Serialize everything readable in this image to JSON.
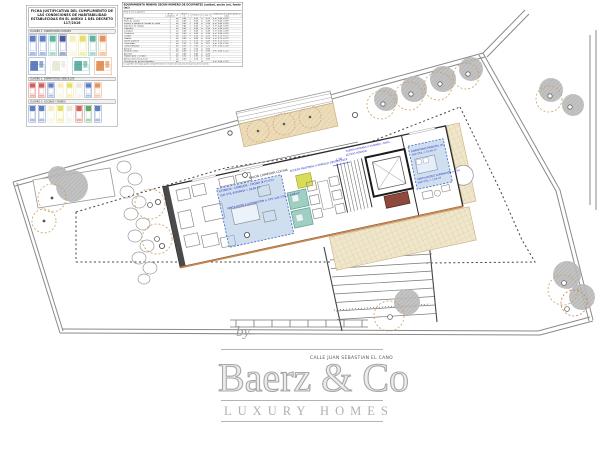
{
  "panel": {
    "title": "FICHA JUSTIFICATIVA DEL CUMPLIMIENTO DE LAS CONDICIONES DE HABITABILIDAD ESTABLECIDAS EN EL ANEXO 1 DEL DECRETO 117/2016",
    "rows": [
      {
        "bar": "CUADRO 1. DORMITORIOS DOBLES",
        "type": "tall",
        "items": [
          "blue",
          "blue",
          "teal",
          "navy",
          "paleYellow",
          "yellow",
          "teal",
          "orange"
        ]
      },
      {
        "bar": "",
        "type": "rooms",
        "items": [
          "blue",
          "pale",
          "teal",
          "orange"
        ]
      },
      {
        "bar": "CUADRO 2. DORMITORIOS SENCILLOS",
        "type": "mid",
        "items": [
          "red",
          "red",
          "blue",
          "paleYellow",
          "yellow",
          "pale",
          "blue",
          "orange"
        ]
      },
      {
        "bar": "CUADRO 3. COCINAS Y BAÑOS",
        "type": "mid2",
        "items": [
          "blue",
          "blue",
          "paleYellow",
          "yellow",
          "pale",
          "red",
          "green",
          "blue"
        ]
      }
    ]
  },
  "table": {
    "title": "EQUIPAMIENTO MÍNIMO SEGÚN NÚMERO DE OCUPANTES (unidad, ancho (m), fondo (m))",
    "subtitle": "Para 5 ó 6 ocupantes",
    "col_headers": [
      "",
      "Nº de unidades",
      "ud",
      "Ancho m",
      "x",
      "Fondo m",
      "=",
      "Sup. m²",
      "Condiciones de la pieza donde se ubica"
    ],
    "rows": [
      [
        "Fregadero",
        "1",
        "ud",
        "0,45",
        "x",
        "0,50",
        "=",
        "0,23",
        "≥ m² 0,45 x 0,90"
      ],
      [
        "Plano de cocción",
        "1",
        "ud",
        "0,60",
        "x",
        "0,60",
        "=",
        "0,36",
        "≥ m² 0,60 x 0,90"
      ],
      [
        "Espacio o aparato del lavado de vajilla",
        "1",
        "ud",
        "0,60",
        "x",
        "0,60",
        "=",
        "0,36",
        "≥ m² 0,60 x 0,90"
      ],
      [
        "Superficie de trabajo",
        "1",
        "ud",
        "0,45",
        "x",
        "0,60",
        "=",
        "0,27",
        "≥ m² 0,45 x 0,90"
      ],
      [
        "Frigorífico",
        "1",
        "ud",
        "0,60",
        "x",
        "0,60",
        "=",
        "0,36",
        "≥ m² 0,60 x 0,90"
      ],
      [
        "Lavadora",
        "1",
        "ud",
        "0,60",
        "x",
        "0,60",
        "=",
        "0,36",
        "≥ m² 0,60 x 0,90"
      ],
      [
        "Tendedero",
        "1",
        "ud",
        "0,60",
        "x",
        "0,60",
        "=",
        "0,36",
        "≥ m² 0,60 x 0,90"
      ],
      [
        "Lavabo",
        "1",
        "ud",
        "0,50",
        "x",
        "0,50",
        "=",
        "0,25",
        "≥ m² 0,70 x 0,70"
      ],
      [
        "Inodoro",
        "1",
        "ud",
        "0,40",
        "x",
        "0,60",
        "=",
        "0,24",
        "≥ m² 0,75 x 0,75"
      ],
      [
        "Ducha o bañera",
        "1",
        "ud",
        "0,70",
        "x",
        "0,70",
        "=",
        "0,49",
        "≥ m² 0,70 x 0,70"
      ],
      [
        "Cama doble",
        "1",
        "ud",
        "1,35",
        "x",
        "1,90",
        "=",
        "2,57",
        "≥ m² 1,35 x 1,90"
      ],
      [
        "Cama individual",
        "2",
        "ud",
        "0,90",
        "x",
        "1,90",
        "=",
        "1,71",
        "≥ m² 0,90 x 1,90"
      ],
      [
        "Armario",
        "2",
        "ud",
        "0,60",
        "x",
        "1,00",
        "=",
        "0,60",
        ""
      ],
      [
        "Mesa de comer",
        "1",
        "ud",
        "0,80",
        "x",
        "1,20",
        "=",
        "0,96",
        "≥ m² 0,80 x 1,20"
      ],
      [
        "Asientos",
        "5",
        "ud",
        "0,45",
        "x",
        "0,45",
        "=",
        "0,20",
        ""
      ],
      [
        "Espacio para el estudio",
        "1",
        "ud",
        "0,50",
        "x",
        "0,90",
        "=",
        "0,45",
        ""
      ],
      [
        "Almacenamiento general",
        "1",
        "ud",
        "0,60",
        "x",
        "1,50",
        "=",
        "0,90",
        ""
      ],
      [
        "Ventilación de piezas habitables",
        "",
        "ud",
        "",
        "x",
        "",
        "=",
        "",
        "≥ m² 0,60 x 1,20"
      ]
    ],
    "footer": "La superficie de trabajo puede compartimentarse en función de cada una de las piezas de la vivienda"
  },
  "plan": {
    "labels": {
      "salon": "SALON COMEDOR COCINA"
    },
    "annotations": {
      "living1": "ESTANCIA - COMEDOR - COCINA (E+C+Co)",
      "living2": "SUP. ÚTIL ESTANCIA = 28,60 m²",
      "living3": "VENTILACIÓN E ILUMINACIÓN ≥ 10% SUP. ÚTIL = 2,86 m²",
      "bed1": "DORMITORIO PRINCIPAL (D)",
      "bed2": "SUP. ÚTIL = 15,40 m²",
      "bed3": "VENTILACIÓN E ILUMINACIÓN ≥ 10%",
      "bed4": "SUP. ÚTIL = 1,54 m²",
      "entrada1": "PUERTA ENTRADA A VIVIENDA / NIVEL",
      "entrada2": "ACCESO RODADO",
      "acceso": "ACCESO PEATONAL A PARCELA DESDE CALLE",
      "dim": "1,50"
    }
  },
  "watermark": {
    "by": "by",
    "address": "CALLE JUAN SEBASTIAN EL CANO",
    "brand": "Baerz & Co",
    "tagline": "LUXURY HOMES"
  },
  "colors": {
    "blue": "#3a5fae",
    "teal": "#3b9e8c",
    "navy": "#1f2f7a",
    "yellow": "#ded649",
    "paleYellow": "#efe9b4",
    "pale": "#e4e2d2",
    "orange": "#d97a35",
    "red": "#c23a35",
    "green": "#3f8f46",
    "annotation_blue": "#1f1fbe",
    "zone_fill": "#9fc0e0",
    "zone_border": "#3a66b8",
    "terrace_tan": "#efe6cb",
    "planting_tan": "#ecdcba",
    "canopy_gray": "#bcbcbc",
    "tree_outline_tan": "#c8a061",
    "terrace_edge_orange": "#c8854a",
    "wall_dark": "#2b2b2b",
    "boundary_gray": "#8a8a8a",
    "watermark_gray": "#b3b3b3"
  }
}
